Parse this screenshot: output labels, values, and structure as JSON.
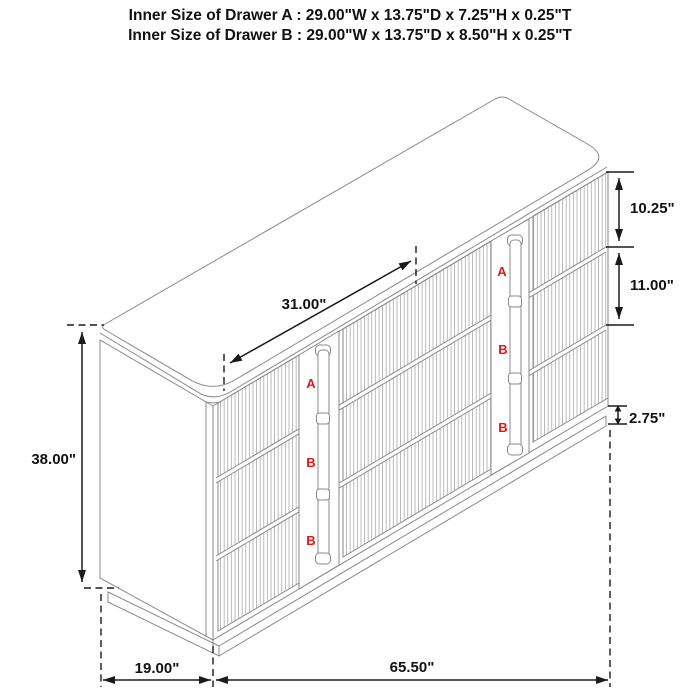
{
  "title": {
    "line1": "Inner Size of Drawer A : 29.00\"W x 13.75\"D x 7.25\"H x 0.25\"T",
    "line2": "Inner Size of Drawer B : 29.00\"W x 13.75\"D x 8.50\"H x 0.25\"T"
  },
  "dimension_labels": {
    "top_diagonal": "31.00\"",
    "left_height": "38.00\"",
    "right_drawer_a": "10.25\"",
    "right_drawer_b": "11.00\"",
    "base_height": "2.75\"",
    "bottom_depth": "19.00\"",
    "bottom_width": "65.50\""
  },
  "drawer_labels": {
    "left_strip": [
      "A",
      "B",
      "B"
    ],
    "right_strip": [
      "A",
      "B",
      "B"
    ]
  },
  "colors": {
    "background": "#ffffff",
    "cabinet_line": "#8a8a8a",
    "flute_line": "#a8a8a8",
    "dimension_line": "#1a1a1a",
    "text": "#111111",
    "drawer_label": "#e01818"
  }
}
